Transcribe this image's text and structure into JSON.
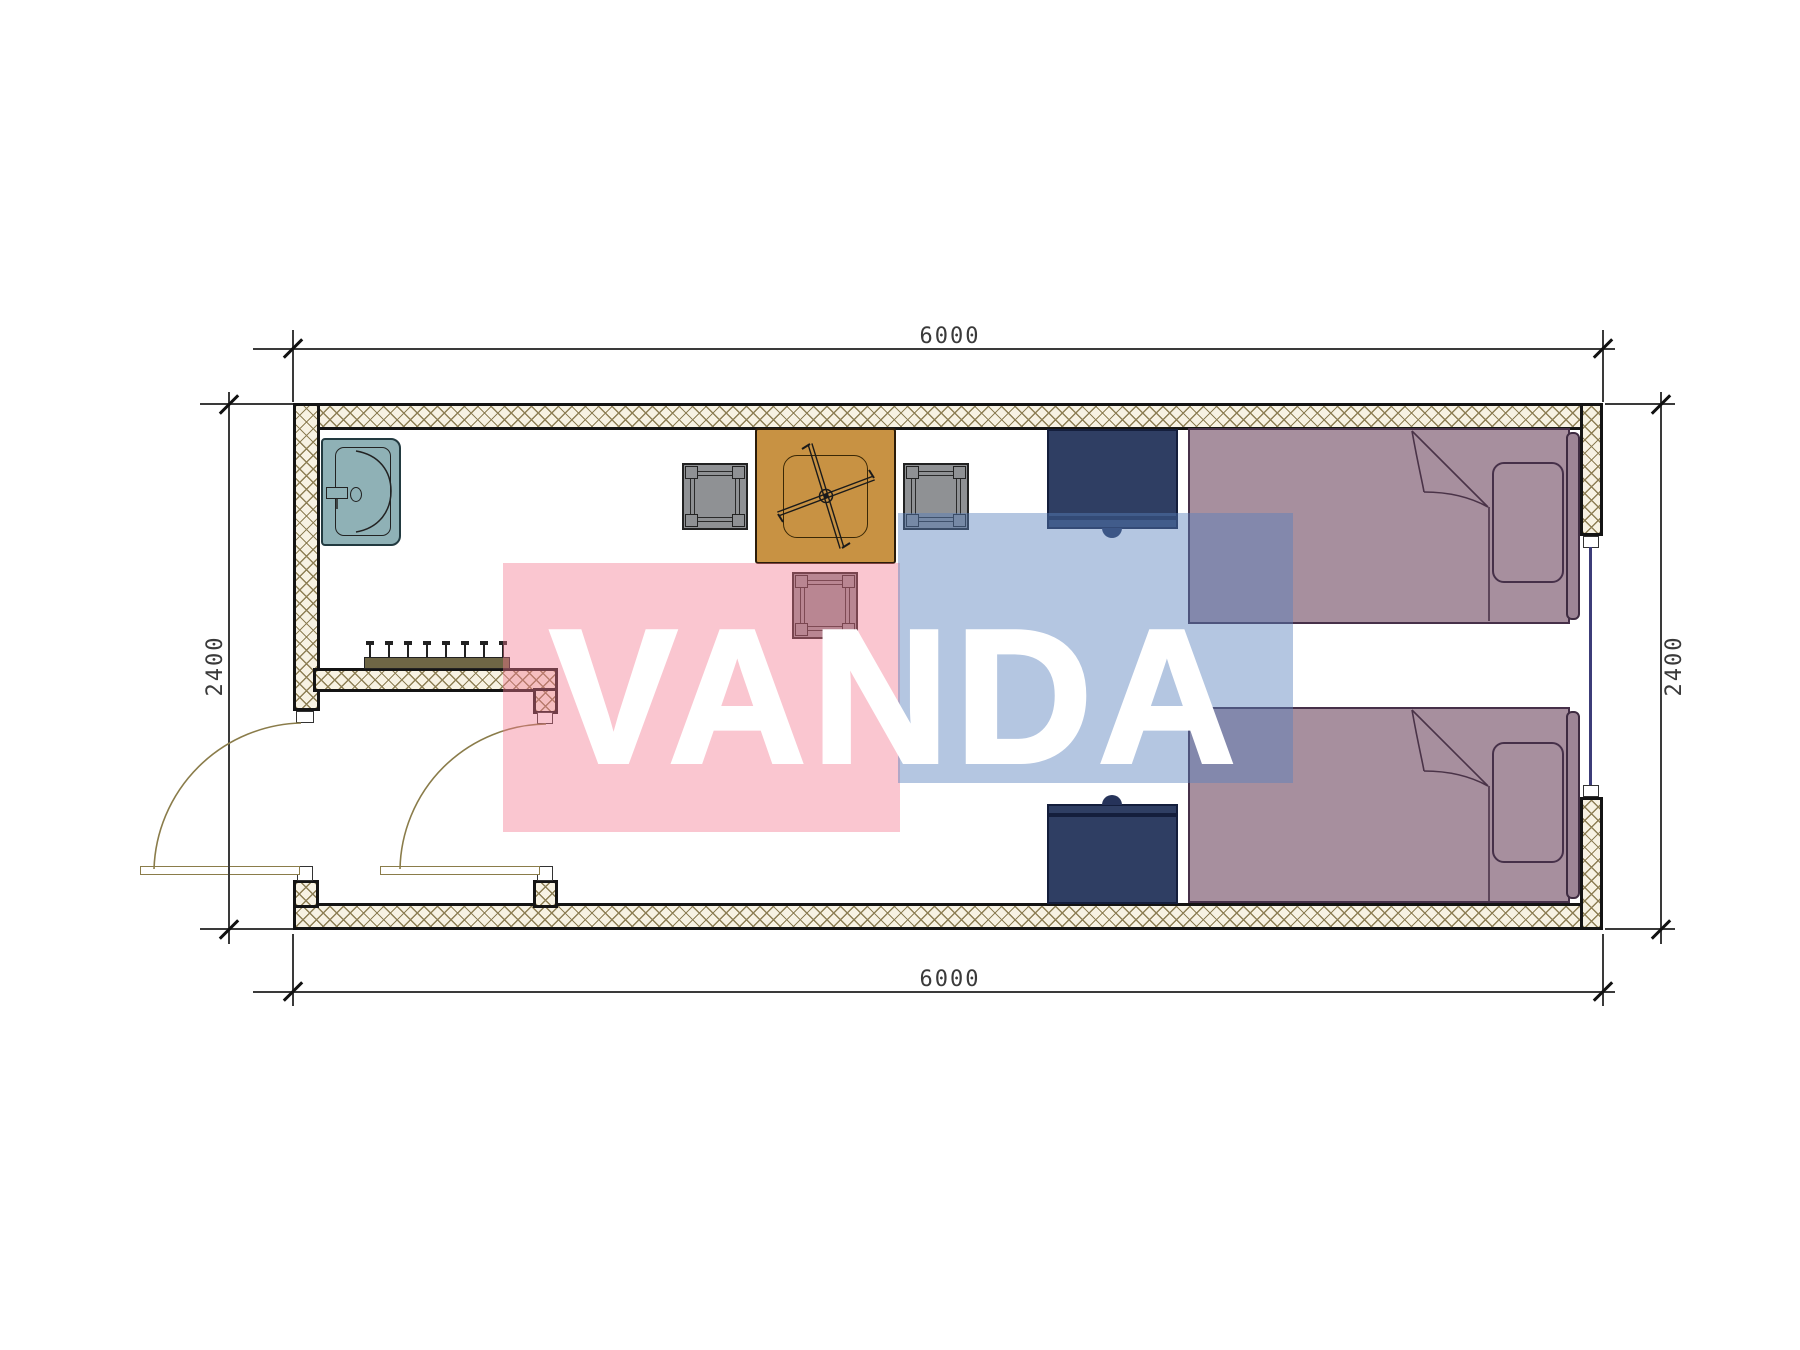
{
  "drawing": {
    "type": "floor-plan",
    "dimensions": {
      "top": "6000",
      "bottom": "6000",
      "left": "2400",
      "right": "2400"
    },
    "watermark": {
      "text": "VANDA"
    },
    "colors": {
      "wall_fill": "#F7F2E3",
      "hatch": "#8D7F55",
      "line": "#141414",
      "dim": "#3A3A3A",
      "sink": "#8FB1B6",
      "table": "#C89243",
      "chair": "#8F9194",
      "nightstand": "#2F3E63",
      "bed": "#A78F9E",
      "door": "#8A7C4A",
      "window": "#3C3C78",
      "rack": "#6E6645",
      "watermark_pink": "rgba(244,120,142,0.42)",
      "watermark_blue": "rgba(88,128,188,0.45)",
      "watermark_text_color": "#FFFFFF"
    }
  }
}
